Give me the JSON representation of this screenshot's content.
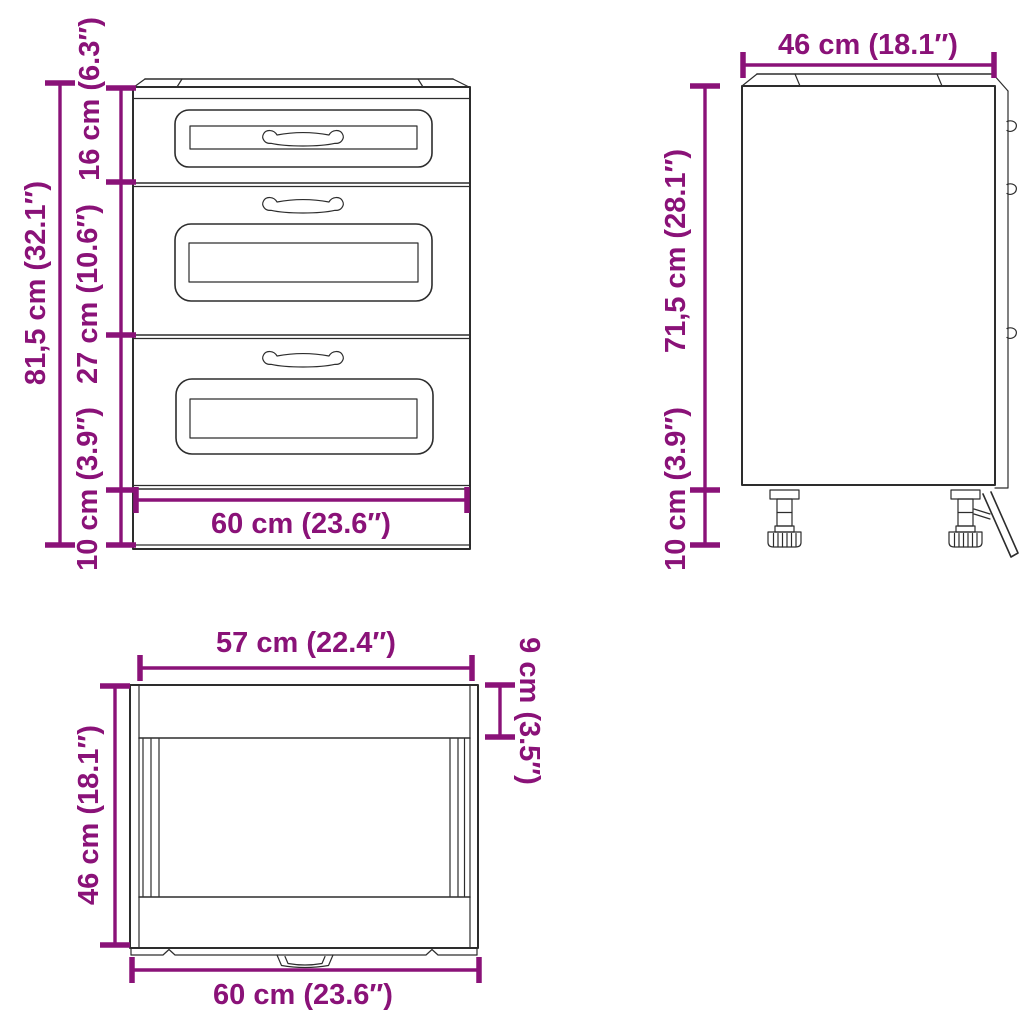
{
  "colors": {
    "dimension": "#8A1278",
    "line_art": "#2D2D2D",
    "background": "#FFFFFF"
  },
  "views": {
    "front": {
      "dimensions": {
        "total_height": "81,5 cm (32.1″)",
        "top_drawer_height": "16 cm (6.3″)",
        "middle_drawer_height": "27 cm (10.6″)",
        "plinth_height": "10 cm (3.9″)",
        "overall_width": "60 cm (23.6″)"
      }
    },
    "side": {
      "dimensions": {
        "depth": "46 cm (18.1″)",
        "carcass_height": "71,5 cm (28.1″)",
        "leg_height": "10 cm (3.9″)"
      }
    },
    "top": {
      "dimensions": {
        "inner_width": "57 cm (22.4″)",
        "depth": "46 cm (18.1″)",
        "front_rail_depth": "9 cm (3.5″)",
        "overall_width": "60 cm (23.6″)"
      }
    }
  }
}
